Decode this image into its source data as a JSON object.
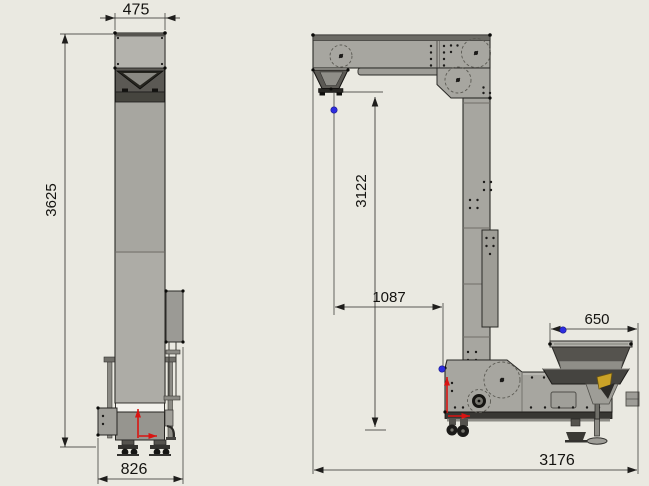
{
  "drawing": {
    "subject": "Z-type bucket elevator conveyor, two orthographic views",
    "views": {
      "front": "front elevation",
      "side": "side elevation"
    }
  },
  "dims": {
    "front": {
      "top_width": "475",
      "overall_height": "3625",
      "base_width": "826"
    },
    "side": {
      "vertical_drop": "3122",
      "horizontal_offset": "1087",
      "hopper_length": "650",
      "overall_length": "3176"
    }
  },
  "colors": {
    "background": "#eae9e1",
    "machine_gray": "#a7a6a0",
    "dark_panel": "#55534e",
    "dimension_line": "#2a2926",
    "handle_blue": "#2d2de0",
    "origin_axis_red": "#d91412",
    "accent_yellow": "#c9a227"
  },
  "markers": {
    "handle_dot": "dimension-grab-handle",
    "origin": "coordinate-origin-arrows"
  }
}
